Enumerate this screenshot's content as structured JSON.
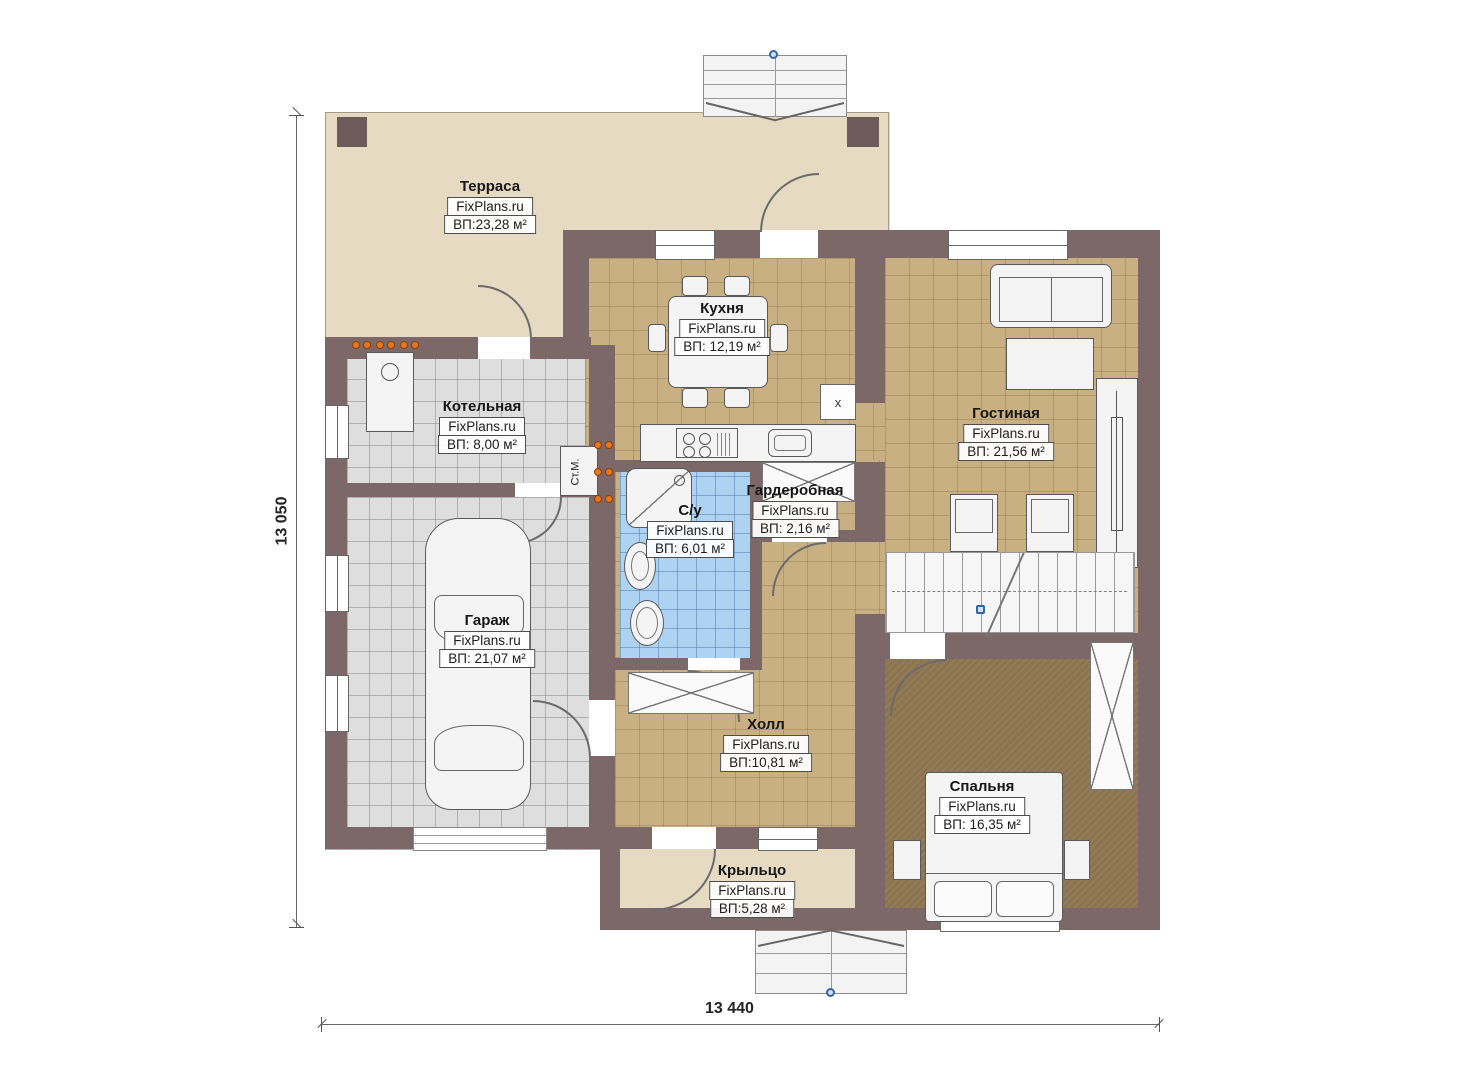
{
  "dimensions": {
    "left": "13 050",
    "bottom": "13 440"
  },
  "rooms": {
    "terrace": {
      "name": "Терраса",
      "brand": "FixPlans.ru",
      "area": "ВП:23,28 м²"
    },
    "kitchen": {
      "name": "Кухня",
      "brand": "FixPlans.ru",
      "area": "ВП: 12,19 м²"
    },
    "boiler": {
      "name": "Котельная",
      "brand": "FixPlans.ru",
      "area": "ВП: 8,00 м²"
    },
    "living": {
      "name": "Гостиная",
      "brand": "FixPlans.ru",
      "area": "ВП: 21,56 м²"
    },
    "wardrobe": {
      "name": "Гардеробная",
      "brand": "FixPlans.ru",
      "area": "ВП: 2,16 м²"
    },
    "bathroom": {
      "name": "С/у",
      "brand": "FixPlans.ru",
      "area": "ВП: 6,01 м²"
    },
    "garage": {
      "name": "Гараж",
      "brand": "FixPlans.ru",
      "area": "ВП: 21,07 м²"
    },
    "hall": {
      "name": "Холл",
      "brand": "FixPlans.ru",
      "area": "ВП:10,81 м²"
    },
    "bedroom": {
      "name": "Спальня",
      "brand": "FixPlans.ru",
      "area": "ВП: 16,35 м²"
    },
    "porch": {
      "name": "Крыльцо",
      "brand": "FixPlans.ru",
      "area": "ВП:5,28 м²"
    }
  },
  "labels": {
    "washing_machine": "Ст.М.",
    "appliance_x": "х"
  },
  "colors": {
    "wall": "#7c6868",
    "terrace_floor": "#e6dac3",
    "tile_tan": "#c8b083",
    "tile_gray": "#dedede",
    "tile_blue": "#aed2f2",
    "bedroom_floor": "#8c7450",
    "radiator_orange": "#e8761e",
    "marker_blue": "#3465a4"
  }
}
